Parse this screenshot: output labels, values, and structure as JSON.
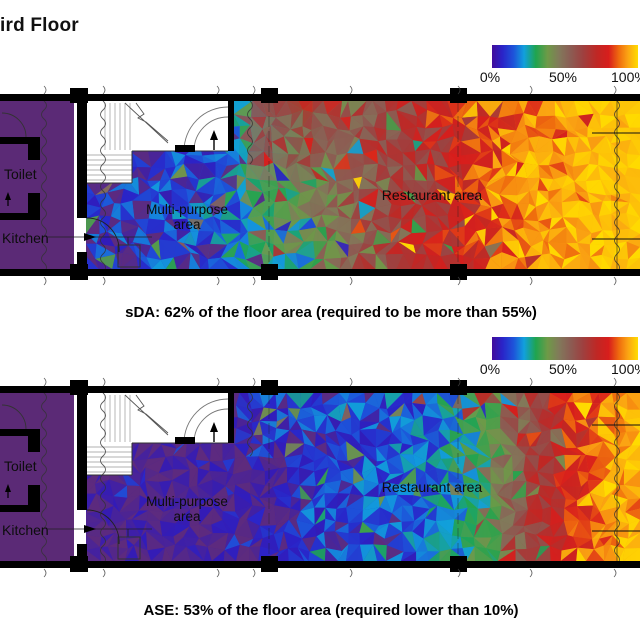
{
  "title": "ird Floor",
  "legend": {
    "tick_labels": [
      "0%",
      "50%",
      "100%"
    ],
    "gradient_stops": [
      [
        0.0,
        "#410d9b"
      ],
      [
        0.07,
        "#2a23c8"
      ],
      [
        0.15,
        "#1d55da"
      ],
      [
        0.22,
        "#11a0dc"
      ],
      [
        0.3,
        "#1fa44f"
      ],
      [
        0.38,
        "#6e9a47"
      ],
      [
        0.46,
        "#82795a"
      ],
      [
        0.53,
        "#8a5f55"
      ],
      [
        0.62,
        "#9d4140"
      ],
      [
        0.72,
        "#c02724"
      ],
      [
        0.8,
        "#d81e1c"
      ],
      [
        0.87,
        "#ef6c0e"
      ],
      [
        0.93,
        "#fba313"
      ],
      [
        1.0,
        "#ffdc00"
      ]
    ]
  },
  "colors": {
    "room_fill": "#5b2a76",
    "low_value_violet": "#5e2b7d",
    "wall": "#000000"
  },
  "plans": [
    {
      "name": "sDA",
      "caption": "sDA: 62% of the floor area (required to be more than 55%)",
      "labels": {
        "toilet": "Toilet",
        "kitchen": "Kitchen",
        "multipurpose": "Multi-purpose area",
        "restaurant": "Restaurant area"
      }
    },
    {
      "name": "ASE",
      "caption": "ASE: 53% of the floor area (required lower than 10%)",
      "labels": {
        "toilet": "Toilet",
        "kitchen": "Kitchen",
        "multipurpose": "Multi-purpose area",
        "restaurant": "Restaurant area"
      }
    }
  ],
  "chart_data": [
    {
      "type": "heatmap",
      "metric": "sDA",
      "result_pct": 62,
      "requirement": "more than 55%",
      "legend_ticks": [
        "0%",
        "50%",
        "100%"
      ],
      "legend_range_pct": [
        0,
        100
      ],
      "rooms": [
        "Toilet",
        "Kitchen",
        "Multi-purpose area",
        "Restaurant area"
      ],
      "value_stops": [
        [
          0.0,
          0.07
        ],
        [
          0.18,
          0.11
        ],
        [
          0.3,
          0.22
        ],
        [
          0.39,
          0.35
        ],
        [
          0.44,
          0.46
        ],
        [
          0.52,
          0.6
        ],
        [
          0.61,
          0.68
        ],
        [
          0.68,
          0.76
        ],
        [
          0.77,
          0.87
        ],
        [
          0.86,
          0.94
        ],
        [
          1.0,
          0.98
        ]
      ],
      "top_band": {
        "x_start": 230,
        "value": 0.67,
        "depth": 260,
        "exp": 1.25
      },
      "noise": 0.13,
      "spike": 0.11,
      "seed": 7
    },
    {
      "type": "heatmap",
      "metric": "ASE",
      "result_pct": 53,
      "requirement": "lower than 10%",
      "legend_ticks": [
        "0%",
        "50%",
        "100%"
      ],
      "legend_range_pct": [
        0,
        100
      ],
      "rooms": [
        "Toilet",
        "Kitchen",
        "Multi-purpose area",
        "Restaurant area"
      ],
      "value_stops": [
        [
          0.0,
          0.015
        ],
        [
          0.3,
          0.02
        ],
        [
          0.36,
          0.05
        ],
        [
          0.41,
          0.08
        ],
        [
          0.5,
          0.12
        ],
        [
          0.6,
          0.16
        ],
        [
          0.68,
          0.26
        ],
        [
          0.73,
          0.36
        ],
        [
          0.77,
          0.5
        ],
        [
          0.82,
          0.66
        ],
        [
          0.87,
          0.79
        ],
        [
          0.93,
          0.89
        ],
        [
          1.0,
          0.96
        ]
      ],
      "top_band": {
        "x_start": 230,
        "value": 0.17,
        "depth": 95,
        "exp": 1.1
      },
      "noise": 0.11,
      "spike": 0.1,
      "seed": 13
    }
  ]
}
